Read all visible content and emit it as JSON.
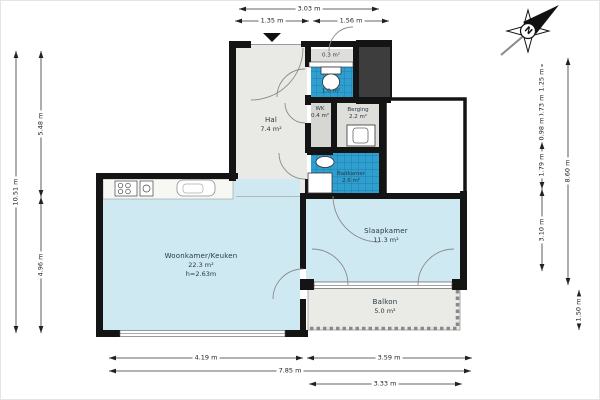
{
  "compass": {
    "north_label": "N"
  },
  "rooms": {
    "hal": {
      "name": "Hal",
      "area": "7.4 m²"
    },
    "meterkast": {
      "area": "0.3 m²"
    },
    "toilet": {
      "area": "1.0 m²"
    },
    "wk": {
      "name": "WK",
      "area": "0.4 m²"
    },
    "berging": {
      "name": "Berging",
      "area": "2.2 m²"
    },
    "badkamer": {
      "name": "Badkamer",
      "area": "2.6 m²"
    },
    "woonkamer": {
      "name": "Woonkamer/Keuken",
      "area": "22.3 m²",
      "ceiling_height": "h=2.63m"
    },
    "slaapkamer": {
      "name": "Slaapkamer",
      "area": "11.3 m²"
    },
    "balkon": {
      "name": "Balkon",
      "area": "5.0 m²"
    }
  },
  "dimensions": {
    "top_total": "3.03 m",
    "top_left": "1.35 m",
    "top_right": "1.56 m",
    "left_total": "10.51 m",
    "left_upper": "5.48 m",
    "left_lower": "4.96 m",
    "right_seg1": "1.25 m",
    "right_seg2": "0.73 m",
    "right_seg3": "0.98 m",
    "right_seg4": "1.79 m",
    "right_seg5": "3.10 m",
    "right_total": "8.60 m",
    "right_balkon": "1.50 m",
    "bottom_left": "4.19 m",
    "bottom_right": "3.59 m",
    "bottom_total": "7.85 m",
    "bottom_balkon": "3.33 m"
  },
  "colors": {
    "wall": "#141414",
    "tile_blue": "#2f9fd0",
    "tile_grout": "#1d7fae",
    "floor_blue": "#cfe9f3",
    "floor_gray": "#e9e9e6"
  }
}
